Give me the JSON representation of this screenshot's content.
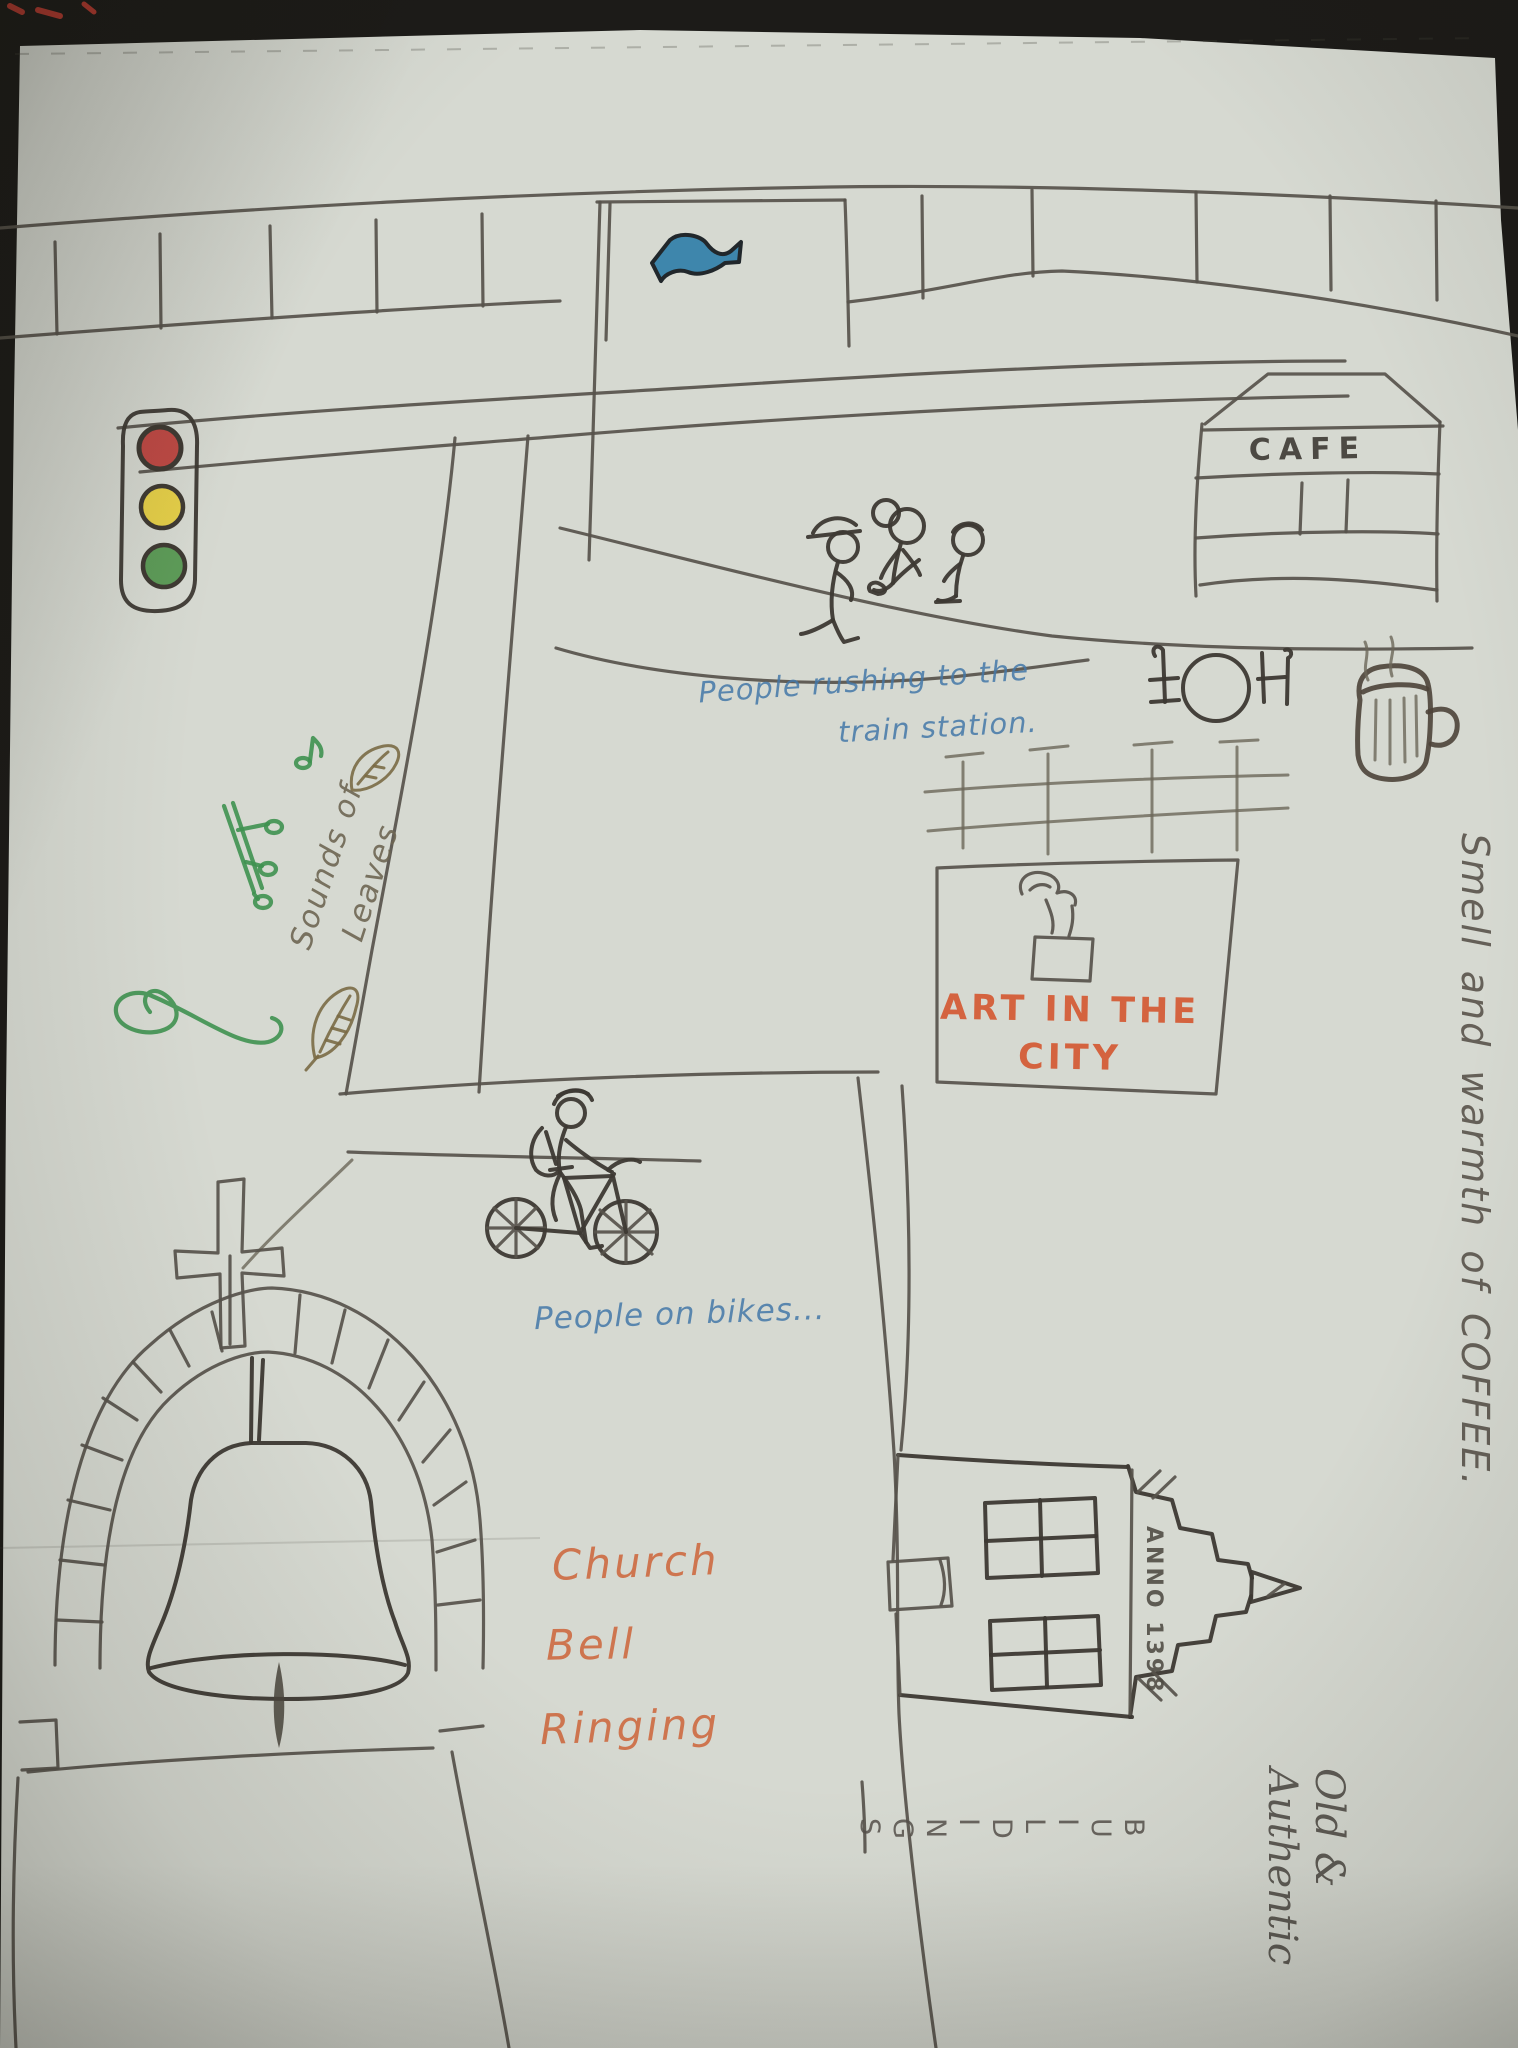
{
  "scene": {
    "type": "hand-drawn city sketch photographed on grey-green paper",
    "cafe": {
      "sign": "CAFE"
    },
    "train_note": {
      "line1": "People rushing to the",
      "line2": "train station."
    },
    "art_billboard": {
      "line1": "ART IN THE",
      "line2": "CITY"
    },
    "leaves_note": {
      "line1": "Sounds of",
      "line2": "Leaves"
    },
    "bikes_note": {
      "text": "People on bikes..."
    },
    "church_note": {
      "line1": "Church",
      "line2": "Bell",
      "line3": "Ringing"
    },
    "coffee_note": {
      "text": "Smell and warmth of COFFEE."
    },
    "house": {
      "anno": "ANNO 1398"
    },
    "old_note": {
      "line1": "Old &",
      "line2": "Authentic",
      "buildings_vertical": "B\nU\nI\nL\nD\nI\nN\nG\nS"
    },
    "icons": {
      "traffic_light": {
        "red": "#bf4a45",
        "yellow": "#e5cf49",
        "green": "#5d9b58"
      },
      "direction_arrow": {
        "fill": "#3e86ac"
      },
      "music_notes_color": "#3f9150",
      "leaf_color": "#7a6a45"
    },
    "colors": {
      "paper": "#d6d9d1",
      "pencil": "#57534b",
      "blue_ink": "#4478a8",
      "orange_ink": "#d4532b",
      "green_ink": "#3f9150"
    }
  }
}
